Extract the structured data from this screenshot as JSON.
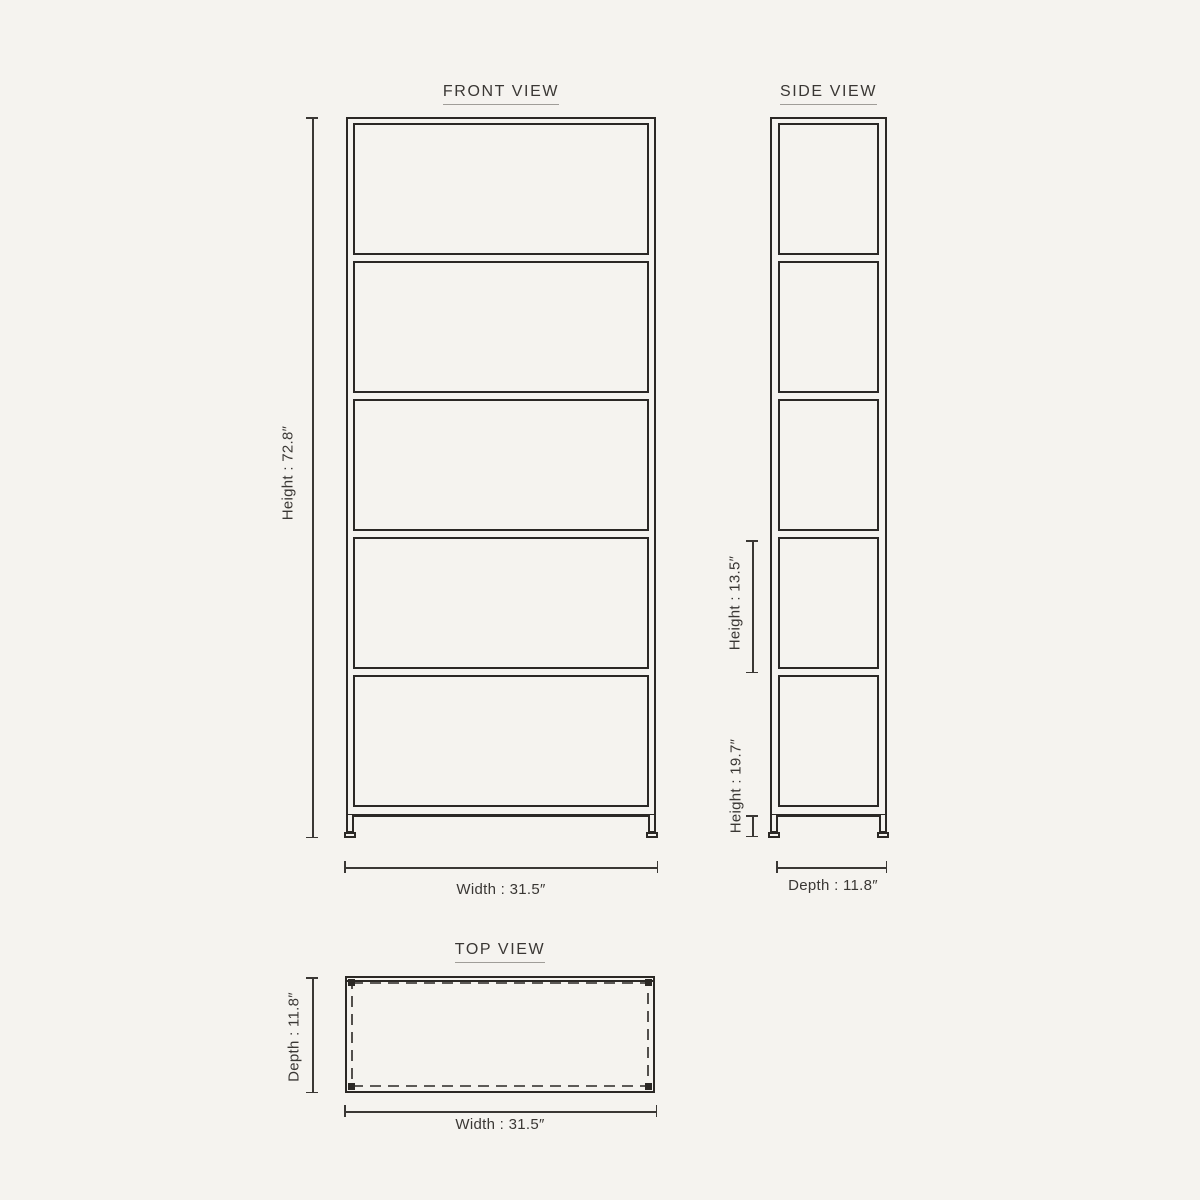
{
  "page": {
    "background": "#f5f3ef",
    "line_color": "#2b2825",
    "dim_color": "#3a3734",
    "underline_color": "#a09d98"
  },
  "front_view": {
    "title": "FRONT VIEW",
    "shelf_count": 5,
    "height_label": "Height : 72.8″",
    "width_label": "Width : 31.5″"
  },
  "side_view": {
    "title": "SIDE VIEW",
    "shelf_count": 5,
    "shelf_height_label": "Height : 13.5″",
    "base_height_label": "Height : 19.7″",
    "depth_label": "Depth : 11.8″"
  },
  "top_view": {
    "title": "TOP VIEW",
    "depth_label": "Depth : 11.8″",
    "width_label": "Width : 31.5″"
  }
}
